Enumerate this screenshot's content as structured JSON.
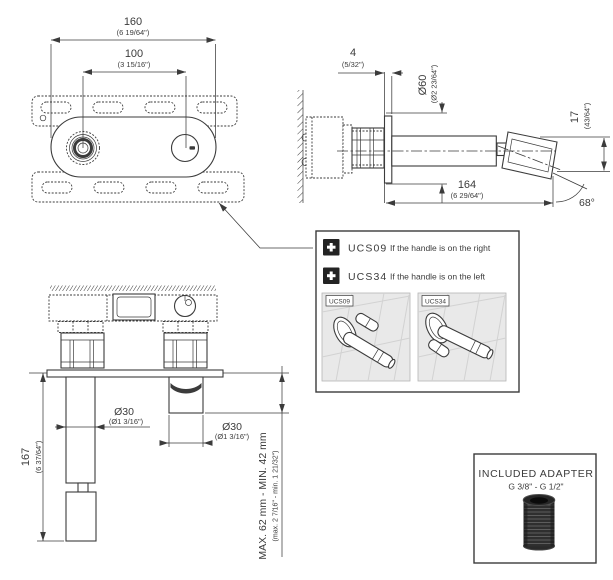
{
  "palette": {
    "line": "#3b3b3b",
    "panel_bg": "#e9e9e9",
    "black_chip": "#232323"
  },
  "plate_view": {
    "dim_overall": {
      "mm": "160",
      "in": "(6 19/64\")"
    },
    "dim_centers": {
      "mm": "100",
      "in": "(3 15/16\")"
    }
  },
  "side_view": {
    "dim_plate_thickness": {
      "mm": "4",
      "in": "(5/32\")"
    },
    "dim_flange_diameter": {
      "mm": "Ø60",
      "in": "(Ø2 23/64\")"
    },
    "dim_tip_drop": {
      "mm": "17",
      "in": "(43/64\")"
    },
    "dim_reach": {
      "mm": "164",
      "in": "(6 29/64\")"
    },
    "angle": "68°"
  },
  "front_view": {
    "dim_height": {
      "mm": "167",
      "in": "(6 37/64\")"
    },
    "dim_spout_diameter": {
      "mm": "Ø30",
      "in": "(Ø1 3/16\")"
    },
    "dim_aerator_diameter": {
      "mm": "Ø30",
      "in": "(Ø1 3/16\")"
    },
    "dim_wall_depth": {
      "mm": "MAX. 62 mm - MIN. 42 mm",
      "in": "(max. 2 7/16\" - min. 1 21/32\")"
    }
  },
  "handle_options": {
    "items": [
      {
        "code": "UCS09",
        "note": "If the handle is on the right"
      },
      {
        "code": "UCS34",
        "note": "If the handle is on the left"
      }
    ],
    "panels": [
      {
        "tag": "UCS09"
      },
      {
        "tag": "UCS34"
      }
    ]
  },
  "adapter": {
    "title": "INCLUDED ADAPTER",
    "spec": "G 3/8\" - G 1/2\""
  }
}
